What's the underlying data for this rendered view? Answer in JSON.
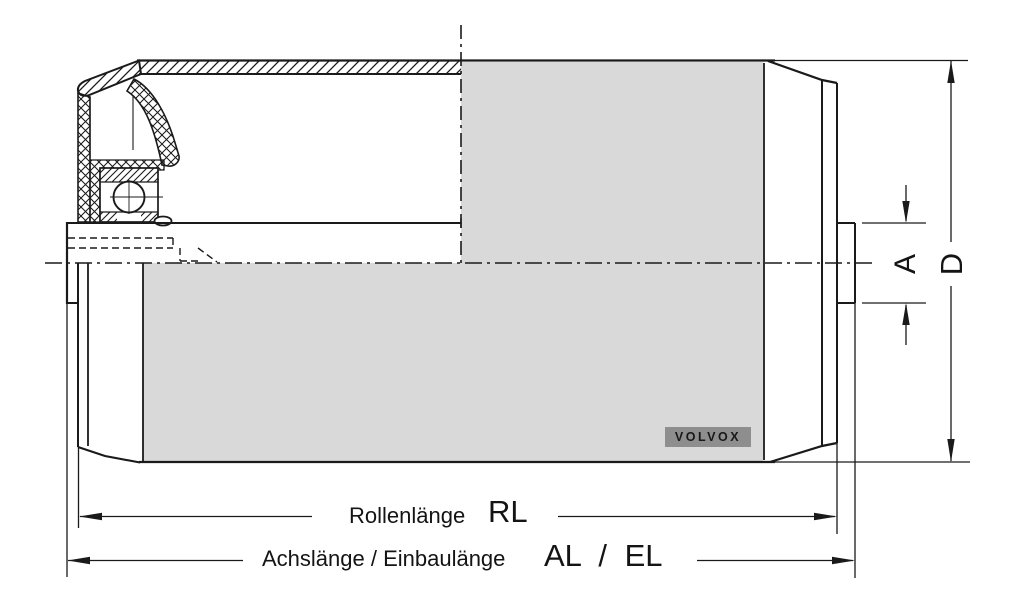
{
  "drawing": {
    "type": "technical-drawing",
    "subject": "conveyor-idler-roller-section",
    "brand_label": "VOLVOX",
    "dimensions": {
      "roller_length": {
        "label": "Rollenlänge",
        "symbol": "RL"
      },
      "installation_length": {
        "label": "Achslänge / Einbaulänge",
        "symbol": "AL / EL"
      },
      "axle_diameter": {
        "symbol": "A"
      },
      "roller_diameter": {
        "symbol": "D"
      }
    },
    "colors": {
      "background": "#ffffff",
      "line": "#1a1a1a",
      "roller_surface": "#d9d9d9",
      "logo_background": "#8e8e8e"
    }
  }
}
